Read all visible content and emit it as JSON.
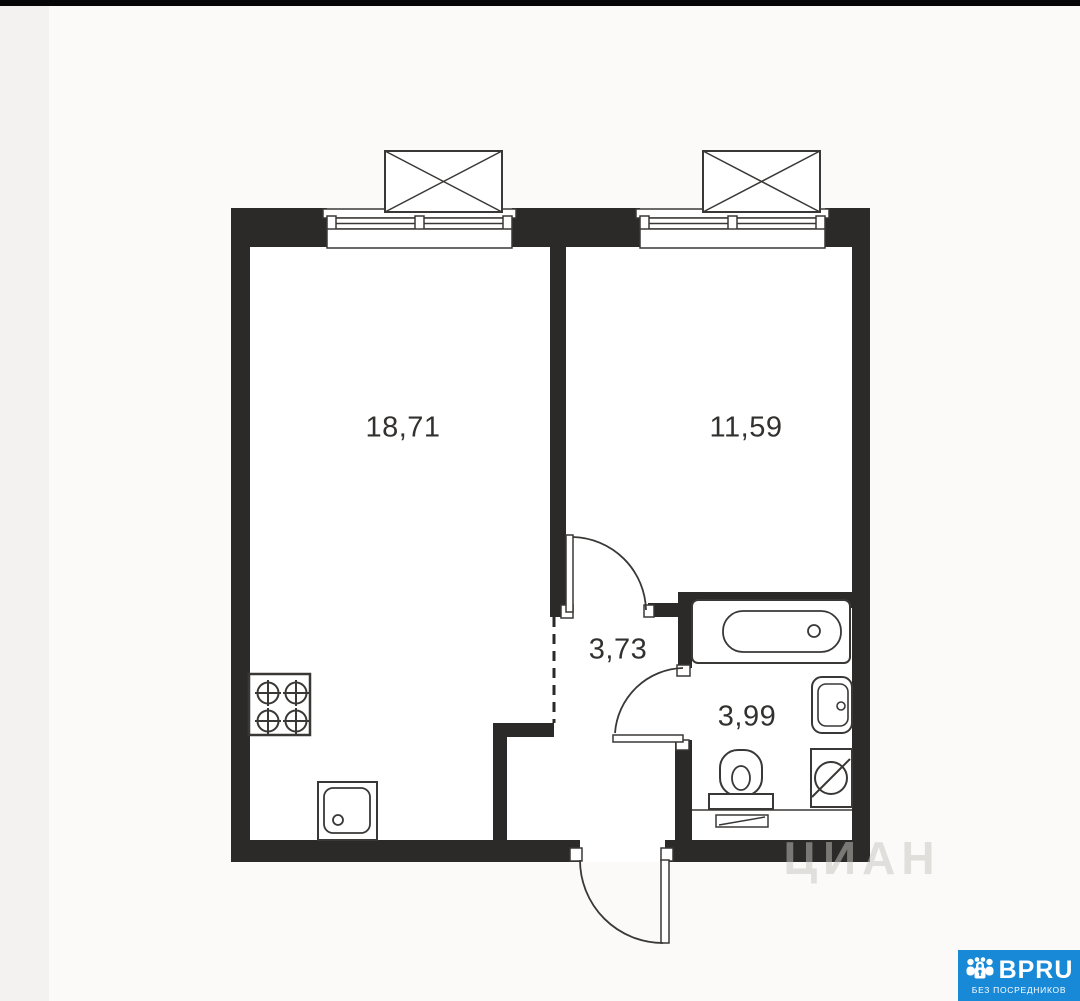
{
  "plan": {
    "rooms": [
      {
        "name": "living-room-kitchen",
        "area_label": "18,71"
      },
      {
        "name": "bedroom",
        "area_label": "11,59"
      },
      {
        "name": "hallway",
        "area_label": "3,73"
      },
      {
        "name": "bathroom",
        "area_label": "3,99"
      }
    ],
    "fixtures": [
      "stove-4-burner",
      "kitchen-sink",
      "bathtub",
      "bathroom-sink",
      "washing-machine",
      "toilet"
    ],
    "features": [
      "window-with-balcony-left",
      "window-with-balcony-right",
      "bedroom-door",
      "bathroom-door",
      "entry-door",
      "open-doorway-dashed"
    ]
  },
  "watermark": {
    "text": "ЦИАН"
  },
  "logo": {
    "brand": "BPRU",
    "tagline": "БЕЗ ПОСРЕДНИКОВ",
    "icon": "people-with-lock-icon"
  },
  "colors": {
    "wall": "#2b2a28",
    "line": "#3a3836",
    "page_bg": "#fbfaf9",
    "left_strip": "#f3f2f0",
    "top_bar": "#060606",
    "logo_blue": "#1789d7",
    "label_text": "#32312f"
  }
}
